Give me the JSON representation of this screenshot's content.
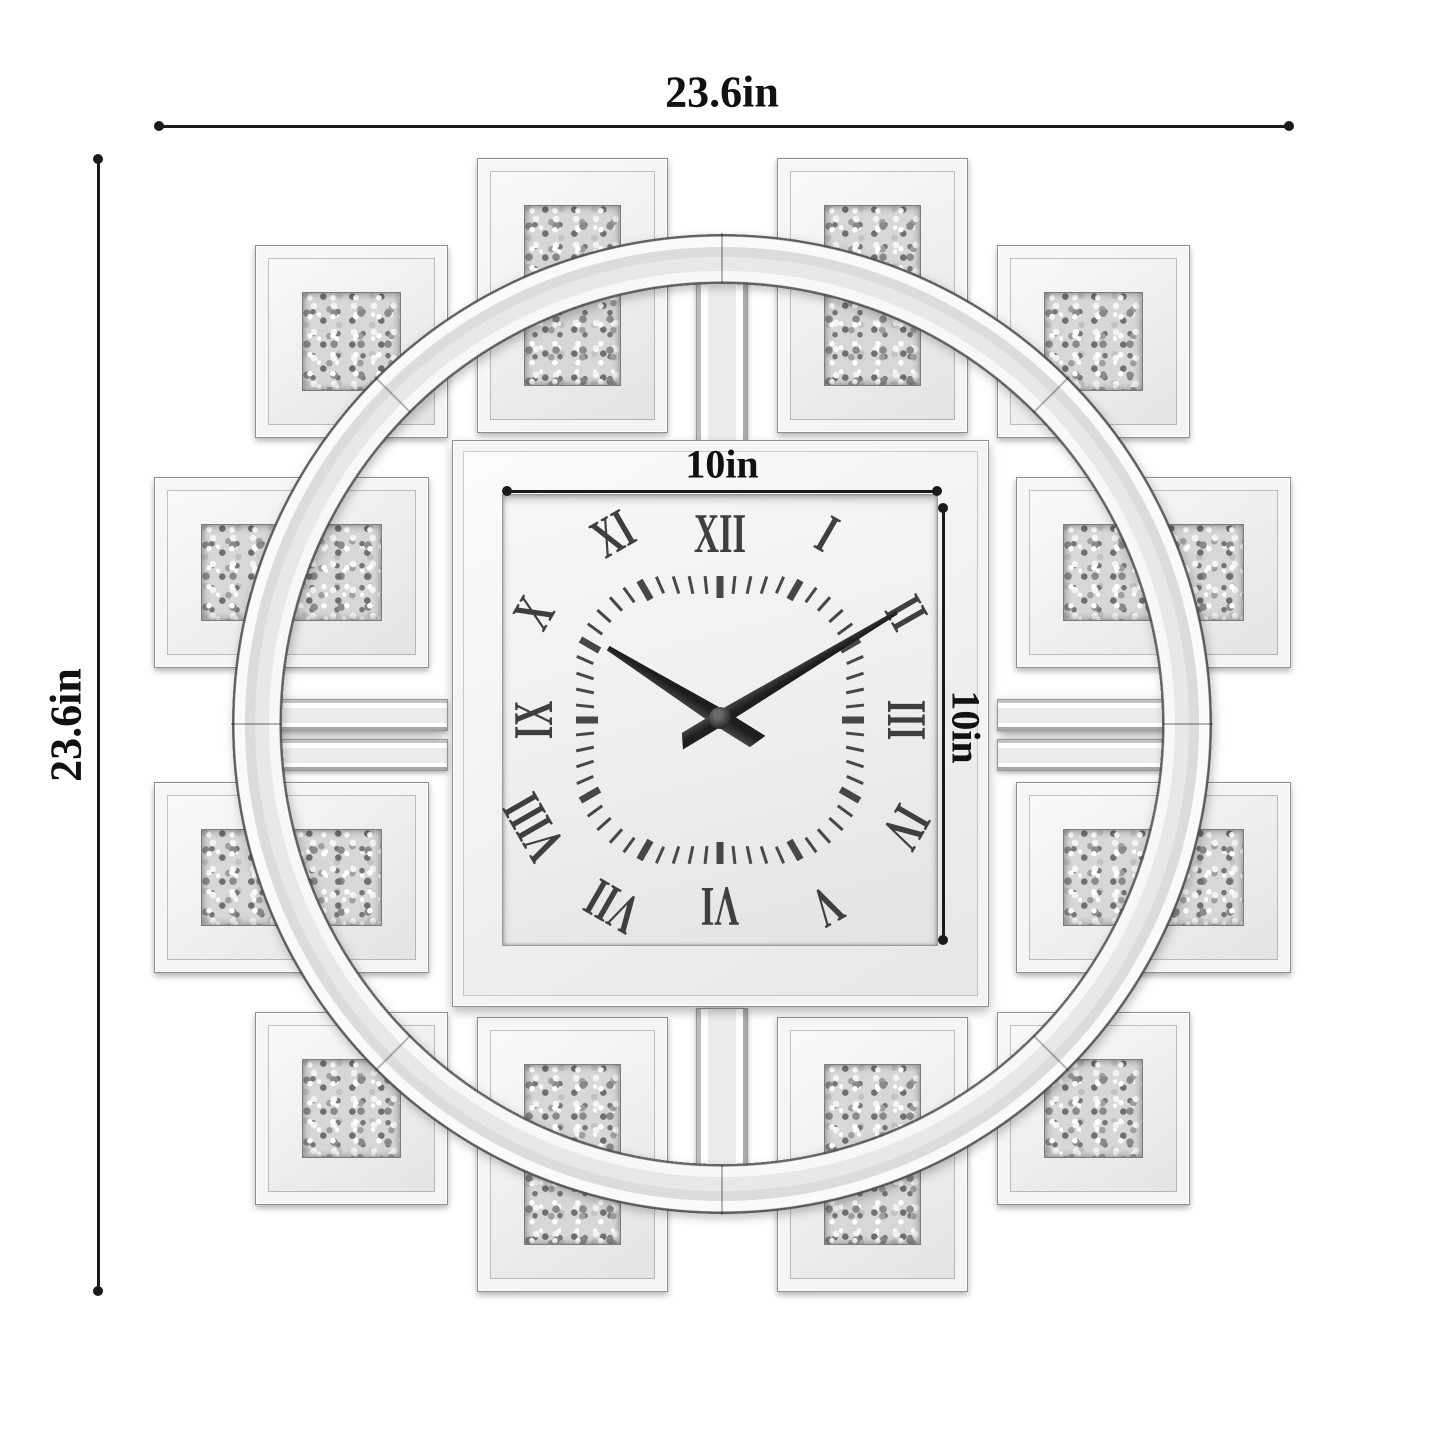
{
  "annotations": {
    "overall_width": "23.6in",
    "overall_height": "23.6in",
    "dial_width": "10in",
    "dial_height": "10in"
  },
  "clock": {
    "numerals": [
      "XII",
      "I",
      "II",
      "III",
      "IV",
      "V",
      "VI",
      "VII",
      "VIII",
      "IX",
      "X",
      "XI"
    ],
    "time": {
      "hour_angle_deg": 302,
      "minute_angle_deg": 59
    },
    "ticks": {
      "minute_count": 60,
      "hour_every": 5
    }
  },
  "colors": {
    "background": "#ffffff",
    "annotation_text": "#111111",
    "dimension_line": "#1a1a1a",
    "numeral": "#3f3f3f",
    "hand": "#2b2b2b",
    "mirror_light": "#f5f5f5",
    "mirror_mid": "#e8e8e8",
    "mirror_edge": "#9a9a9a",
    "crystal_base": "#d7d7d7"
  }
}
